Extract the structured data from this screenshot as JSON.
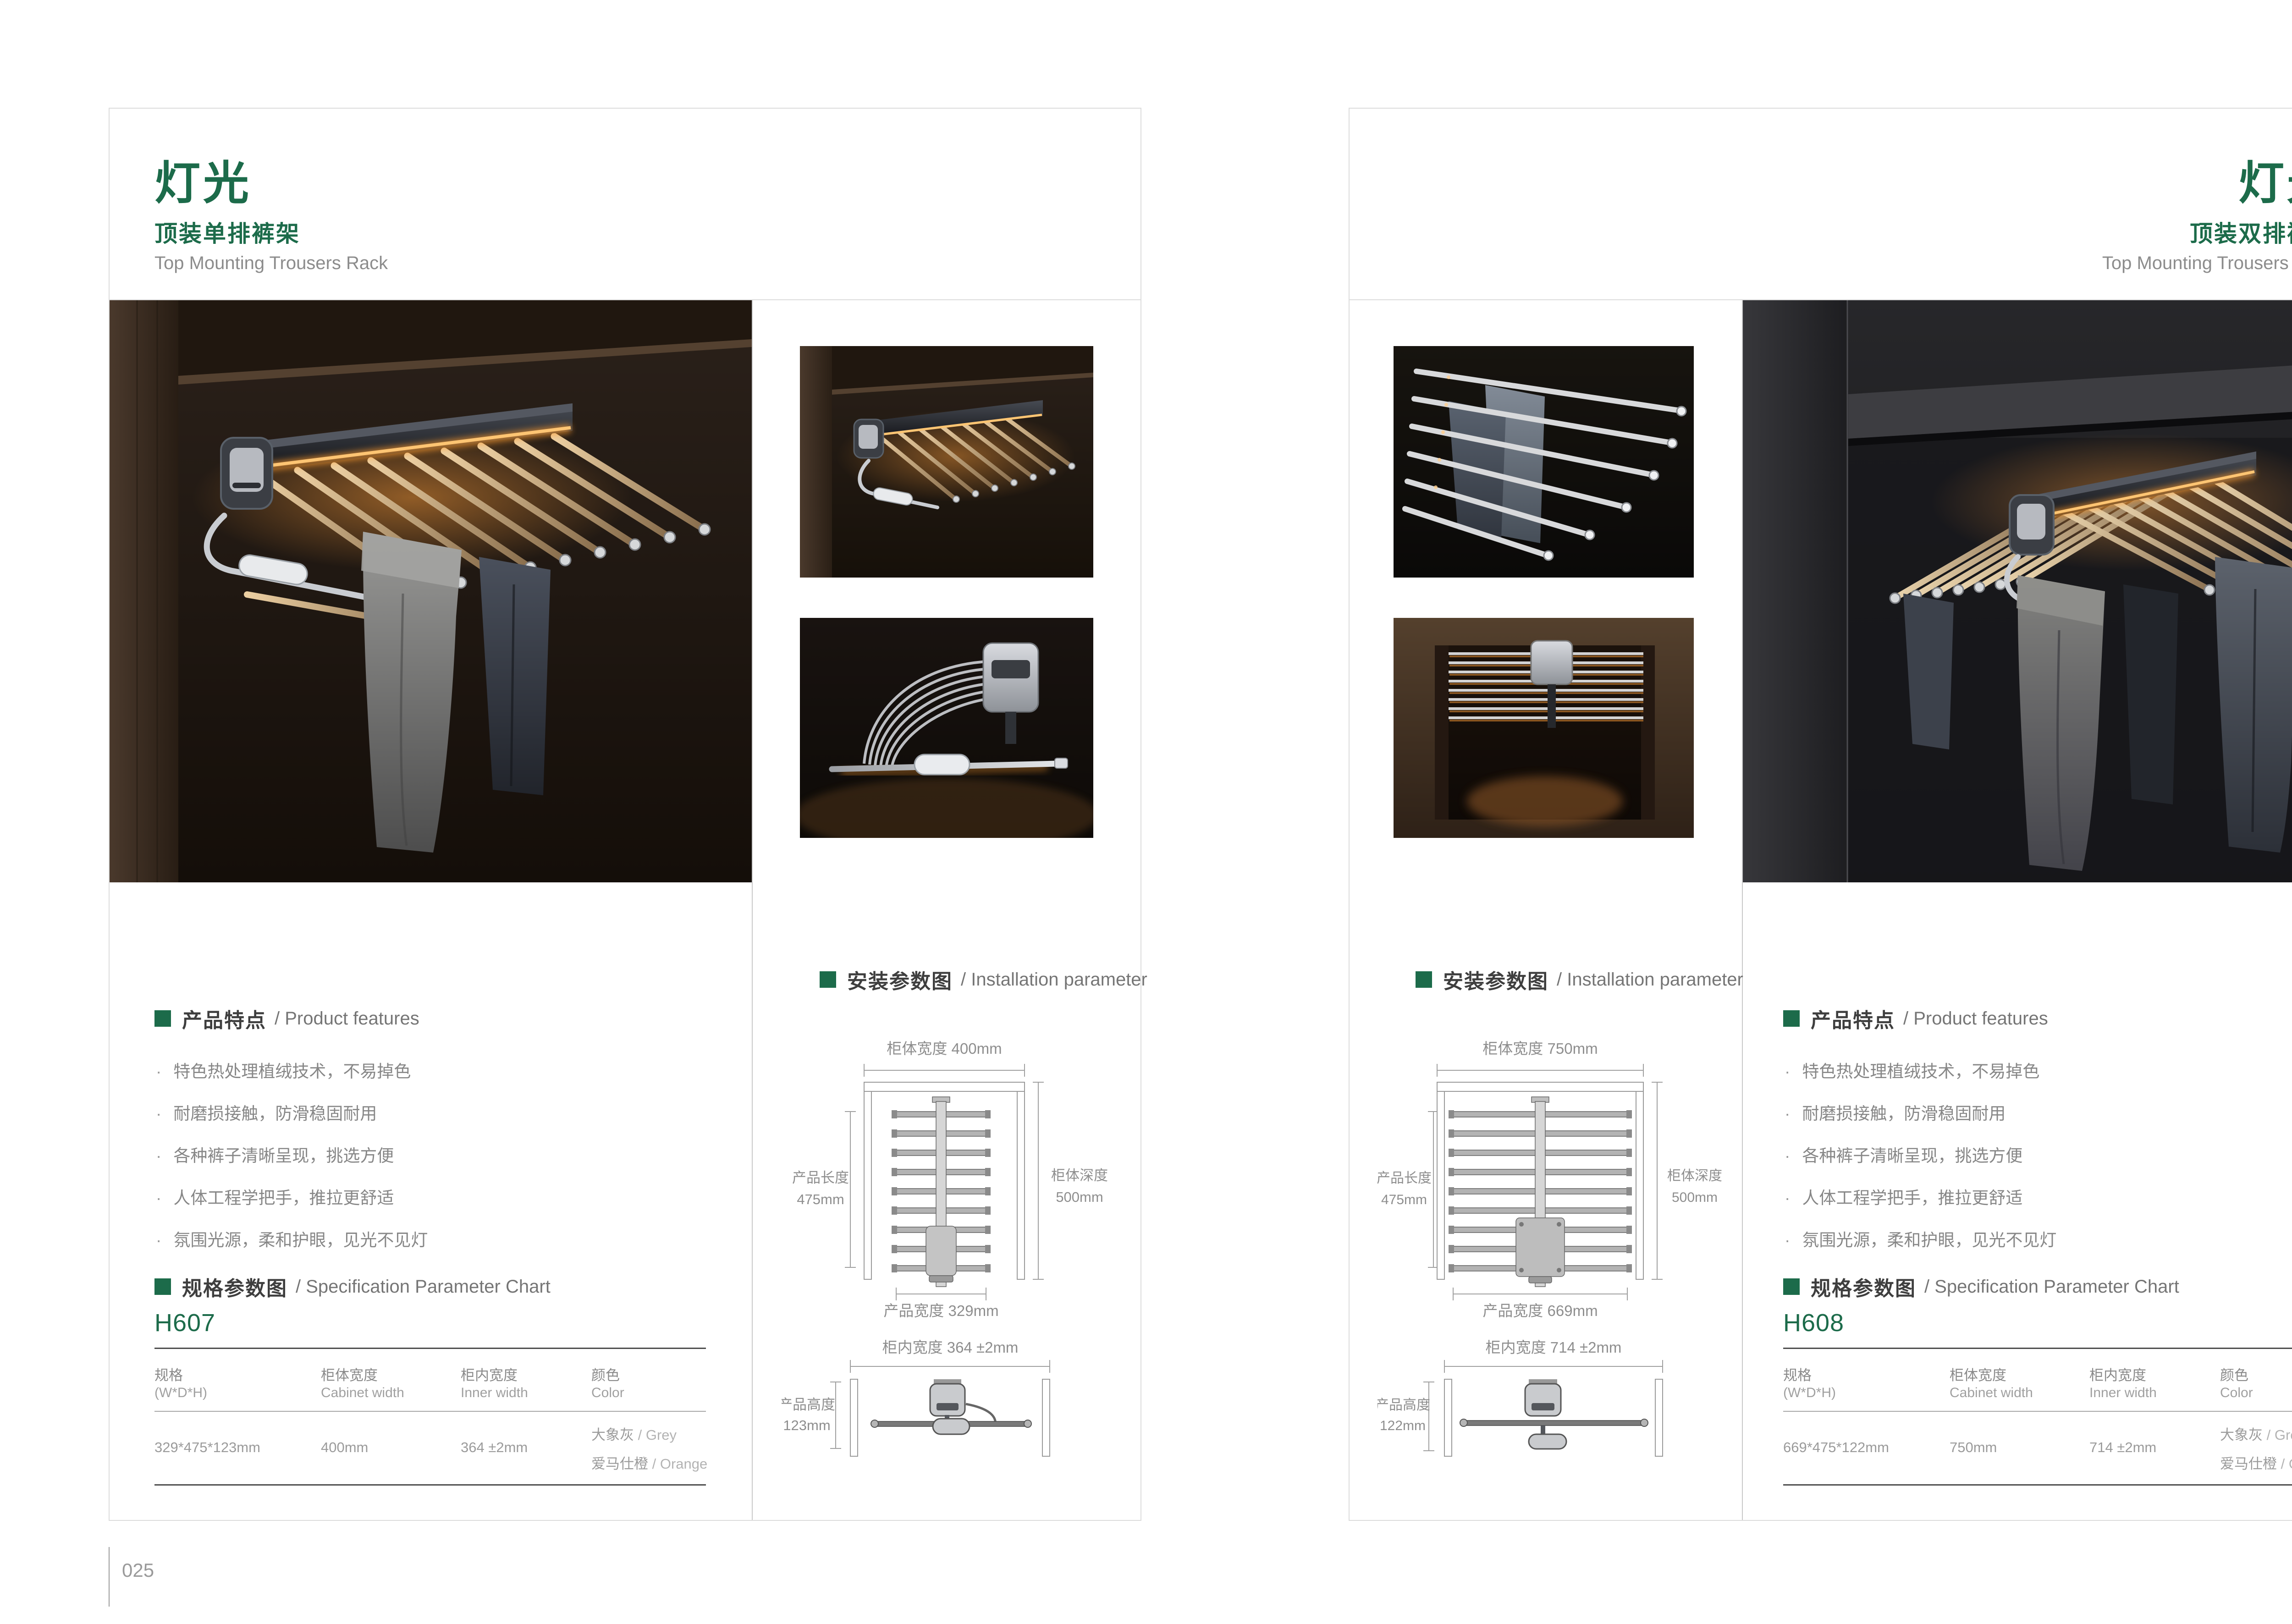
{
  "ui": {
    "bullet": "·"
  },
  "colors": {
    "green": "#1c6b4a",
    "text_dark": "#3e3e3e",
    "text_grey": "#878787",
    "glow": "#f5a441"
  },
  "pages": {
    "left": {
      "title": "灯光",
      "subtitle": "顶装单排裤架",
      "subtitle_en": "Top Mounting Trousers Rack",
      "page_number": "025",
      "features": {
        "heading_cn": "产品特点",
        "heading_en": "/ Product features",
        "items": [
          "特色热处理植绒技术，不易掉色",
          "耐磨损接触，防滑稳固耐用",
          "各种裤子清晰呈现，挑选方便",
          "人体工程学把手，推拉更舒适",
          "氛围光源，柔和护眼，见光不见灯"
        ]
      },
      "spec": {
        "heading_cn": "规格参数图",
        "heading_en": "/ Specification Parameter Chart",
        "model": "H607",
        "col1_cn": "规格",
        "col1_en": "(W*D*H)",
        "col2_cn": "柜体宽度",
        "col2_en": "Cabinet width",
        "col3_cn": "柜内宽度",
        "col3_en": "Inner width",
        "col4_cn": "颜色",
        "col4_en": "Color",
        "val_size": "329*475*123mm",
        "val_cabinet": "400mm",
        "val_inner": "364 ±2mm",
        "color1_cn": "大象灰",
        "color1_en": "/ Grey",
        "color2_cn": "爱马仕橙",
        "color2_en": "/ Orange"
      },
      "install": {
        "heading_cn": "安装参数图",
        "heading_en": "/ Installation parameter",
        "d1_top": "柜体宽度 400mm",
        "d1_left1": "产品长度",
        "d1_left2": "475mm",
        "d1_right1": "柜体深度",
        "d1_right2": "500mm",
        "d1_bottom": "产品宽度 329mm",
        "d2_top": "柜内宽度 364 ±2mm",
        "d2_left1": "产品高度",
        "d2_left2": "123mm"
      }
    },
    "right": {
      "title": "灯光",
      "subtitle": "顶装双排裤架",
      "subtitle_en": "Top Mounting Trousers Rack",
      "page_number": "026",
      "features": {
        "heading_cn": "产品特点",
        "heading_en": "/ Product features",
        "items": [
          "特色热处理植绒技术，不易掉色",
          "耐磨损接触，防滑稳固耐用",
          "各种裤子清晰呈现，挑选方便",
          "人体工程学把手，推拉更舒适",
          "氛围光源，柔和护眼，见光不见灯"
        ]
      },
      "spec": {
        "heading_cn": "规格参数图",
        "heading_en": "/ Specification Parameter Chart",
        "model": "H608",
        "col1_cn": "规格",
        "col1_en": "(W*D*H)",
        "col2_cn": "柜体宽度",
        "col2_en": "Cabinet width",
        "col3_cn": "柜内宽度",
        "col3_en": "Inner width",
        "col4_cn": "颜色",
        "col4_en": "Color",
        "val_size": "669*475*122mm",
        "val_cabinet": "750mm",
        "val_inner": "714 ±2mm",
        "color1_cn": "大象灰",
        "color1_en": "/ Grey",
        "color2_cn": "爱马仕橙",
        "color2_en": "/ Orange"
      },
      "install": {
        "heading_cn": "安装参数图",
        "heading_en": "/ Installation parameter",
        "d1_top": "柜体宽度 750mm",
        "d1_left1": "产品长度",
        "d1_left2": "475mm",
        "d1_right1": "柜体深度",
        "d1_right2": "500mm",
        "d1_bottom": "产品宽度 669mm",
        "d2_top": "柜内宽度 714 ±2mm",
        "d2_left1": "产品高度",
        "d2_left2": "122mm"
      }
    }
  }
}
